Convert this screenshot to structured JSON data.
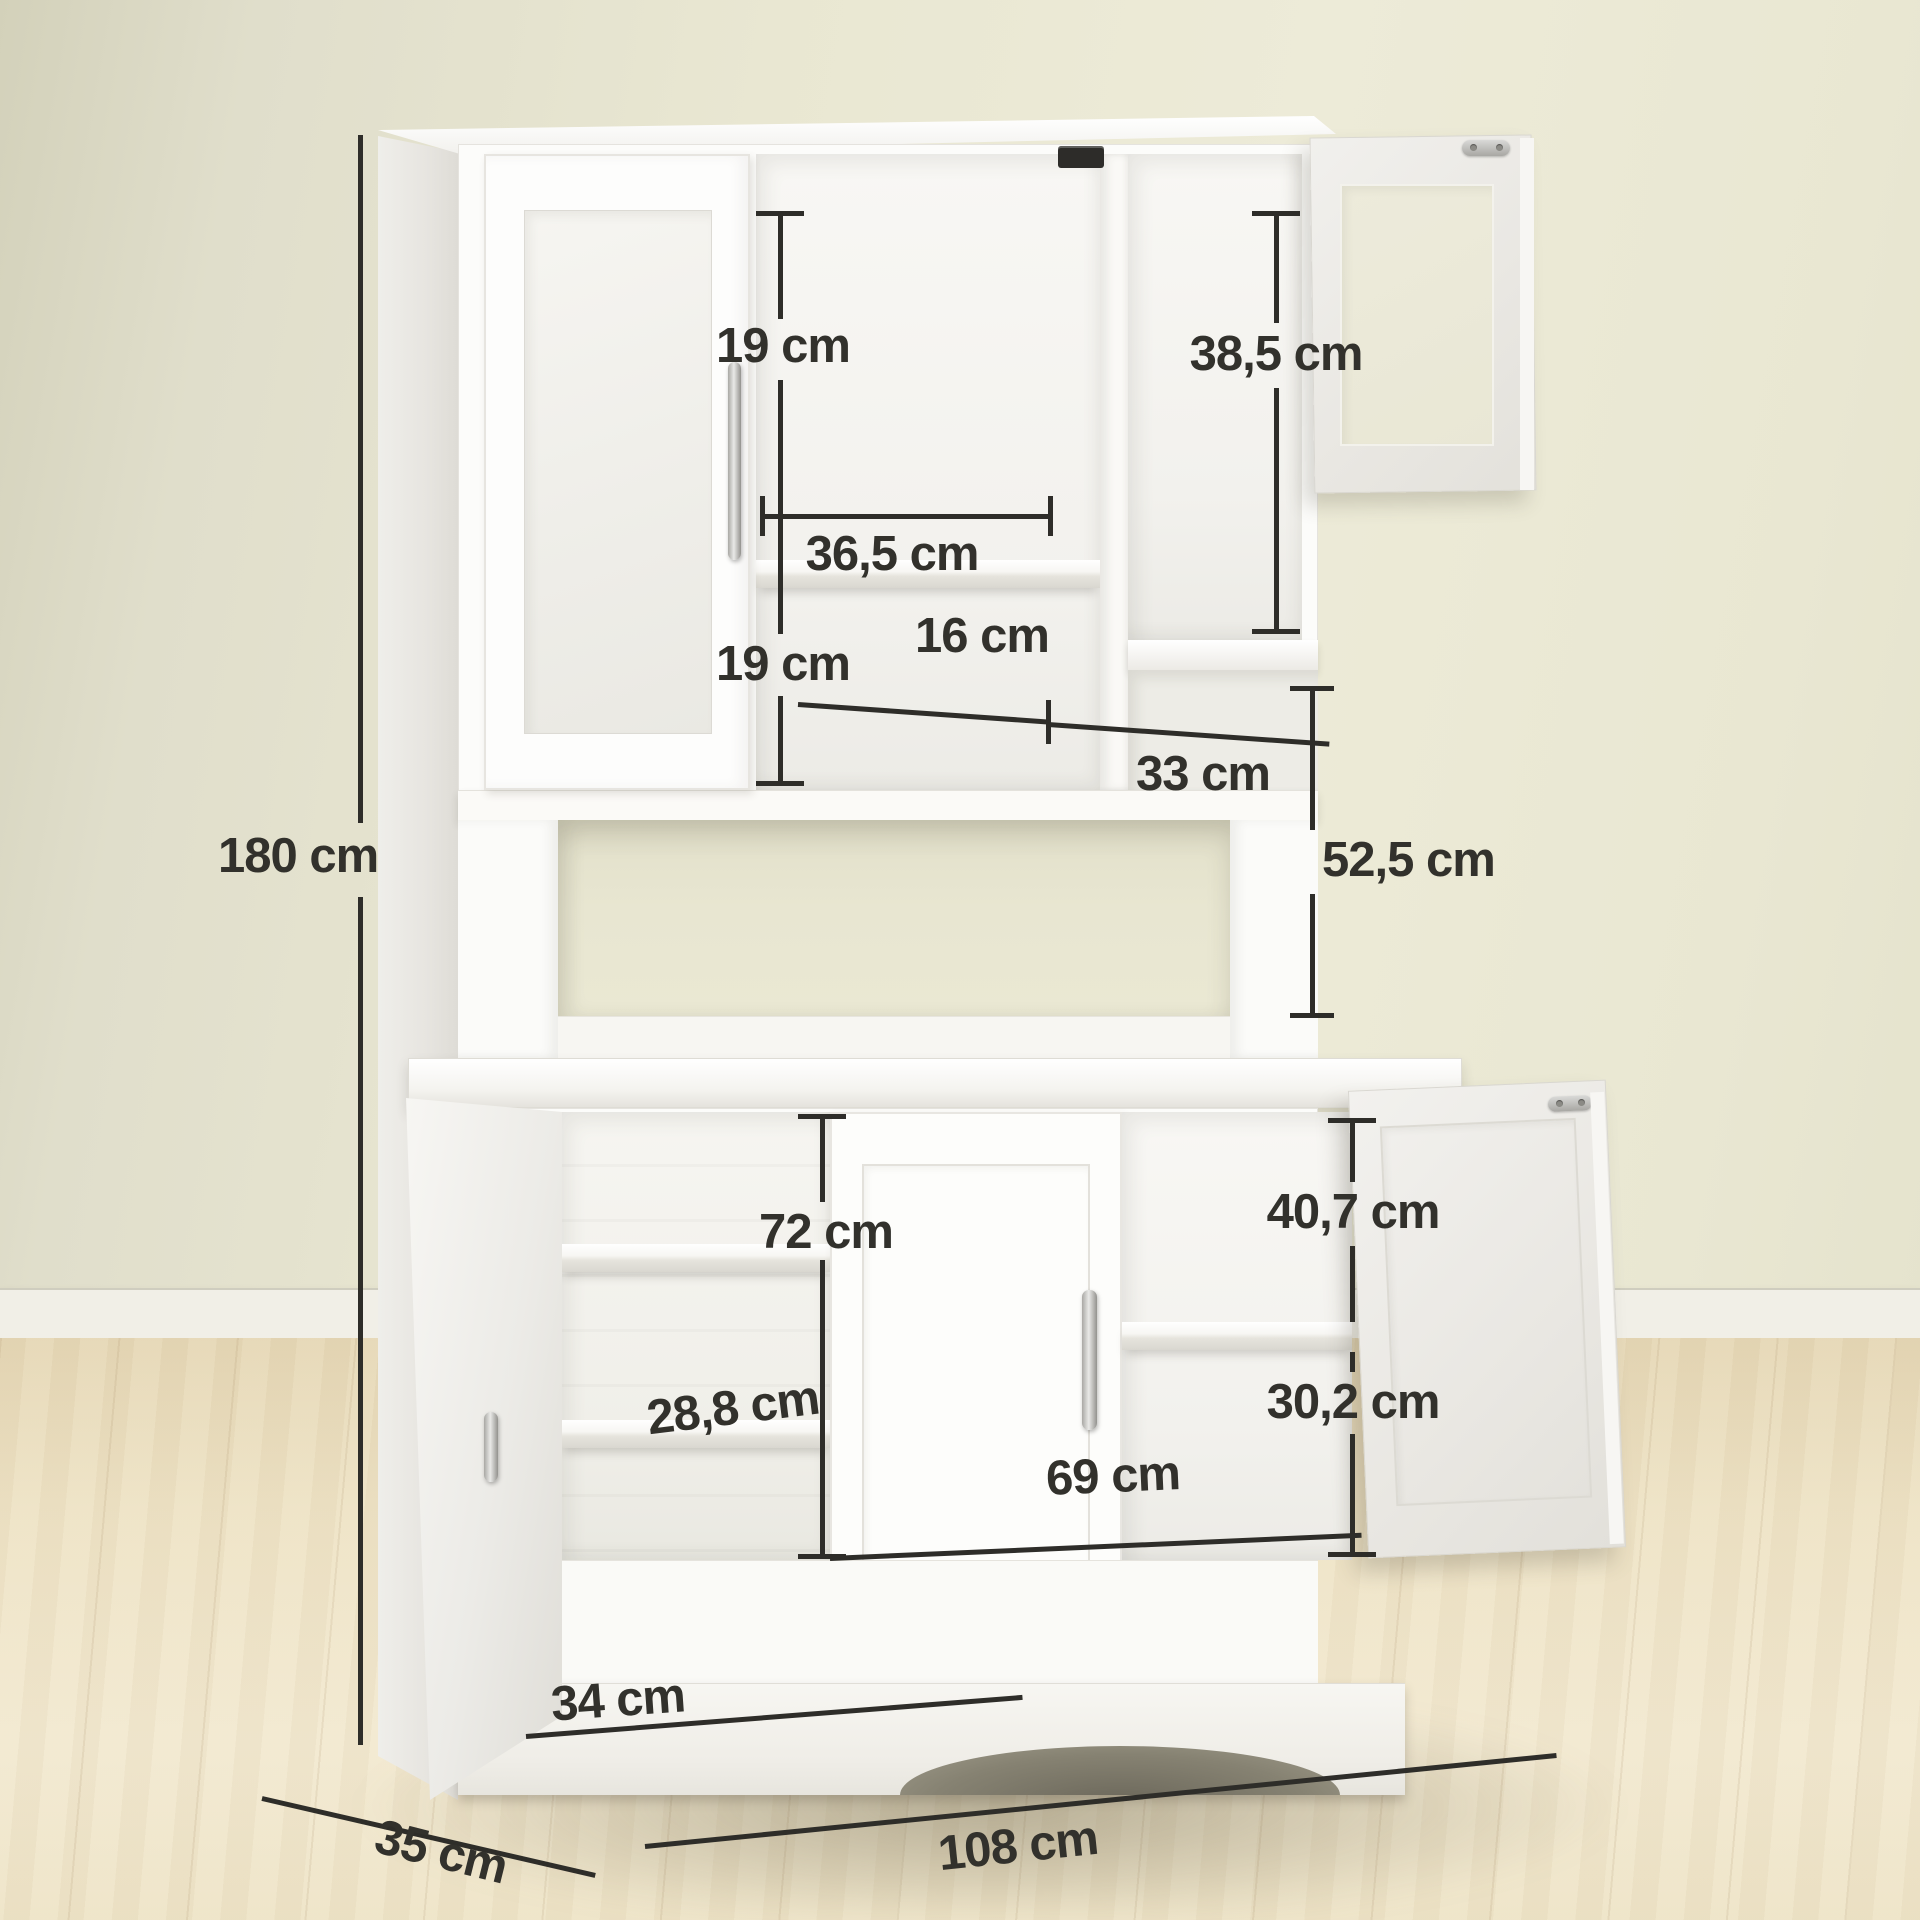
{
  "scene": {
    "wall_color": "#e9e7d2",
    "floor_color": "#eee3c6",
    "cabinet_color": "#fbfbf9",
    "dimension_line_color": "#2e2d29",
    "unit": "cm"
  },
  "product": {
    "overall_height_cm": 180,
    "overall_width_cm": 108,
    "overall_depth_cm": 35
  },
  "dims": {
    "d180": {
      "label": "180 cm",
      "value": 180
    },
    "d19a": {
      "label": "19 cm",
      "value": 19
    },
    "d365": {
      "label": "36,5 cm",
      "value": 36.5
    },
    "d19b": {
      "label": "19 cm",
      "value": 19
    },
    "d385": {
      "label": "38,5 cm",
      "value": 38.5
    },
    "d16": {
      "label": "16 cm",
      "value": 16
    },
    "d33": {
      "label": "33 cm",
      "value": 33
    },
    "d525": {
      "label": "52,5 cm",
      "value": 52.5
    },
    "d72": {
      "label": "72 cm",
      "value": 72
    },
    "d288": {
      "label": "28,8 cm",
      "value": 28.8
    },
    "d407": {
      "label": "40,7 cm",
      "value": 40.7
    },
    "d302": {
      "label": "30,2 cm",
      "value": 30.2
    },
    "d34": {
      "label": "34 cm",
      "value": 34
    },
    "d69": {
      "label": "69 cm",
      "value": 69
    },
    "d108": {
      "label": "108 cm",
      "value": 108
    },
    "d35": {
      "label": "35 cm",
      "value": 35
    }
  }
}
